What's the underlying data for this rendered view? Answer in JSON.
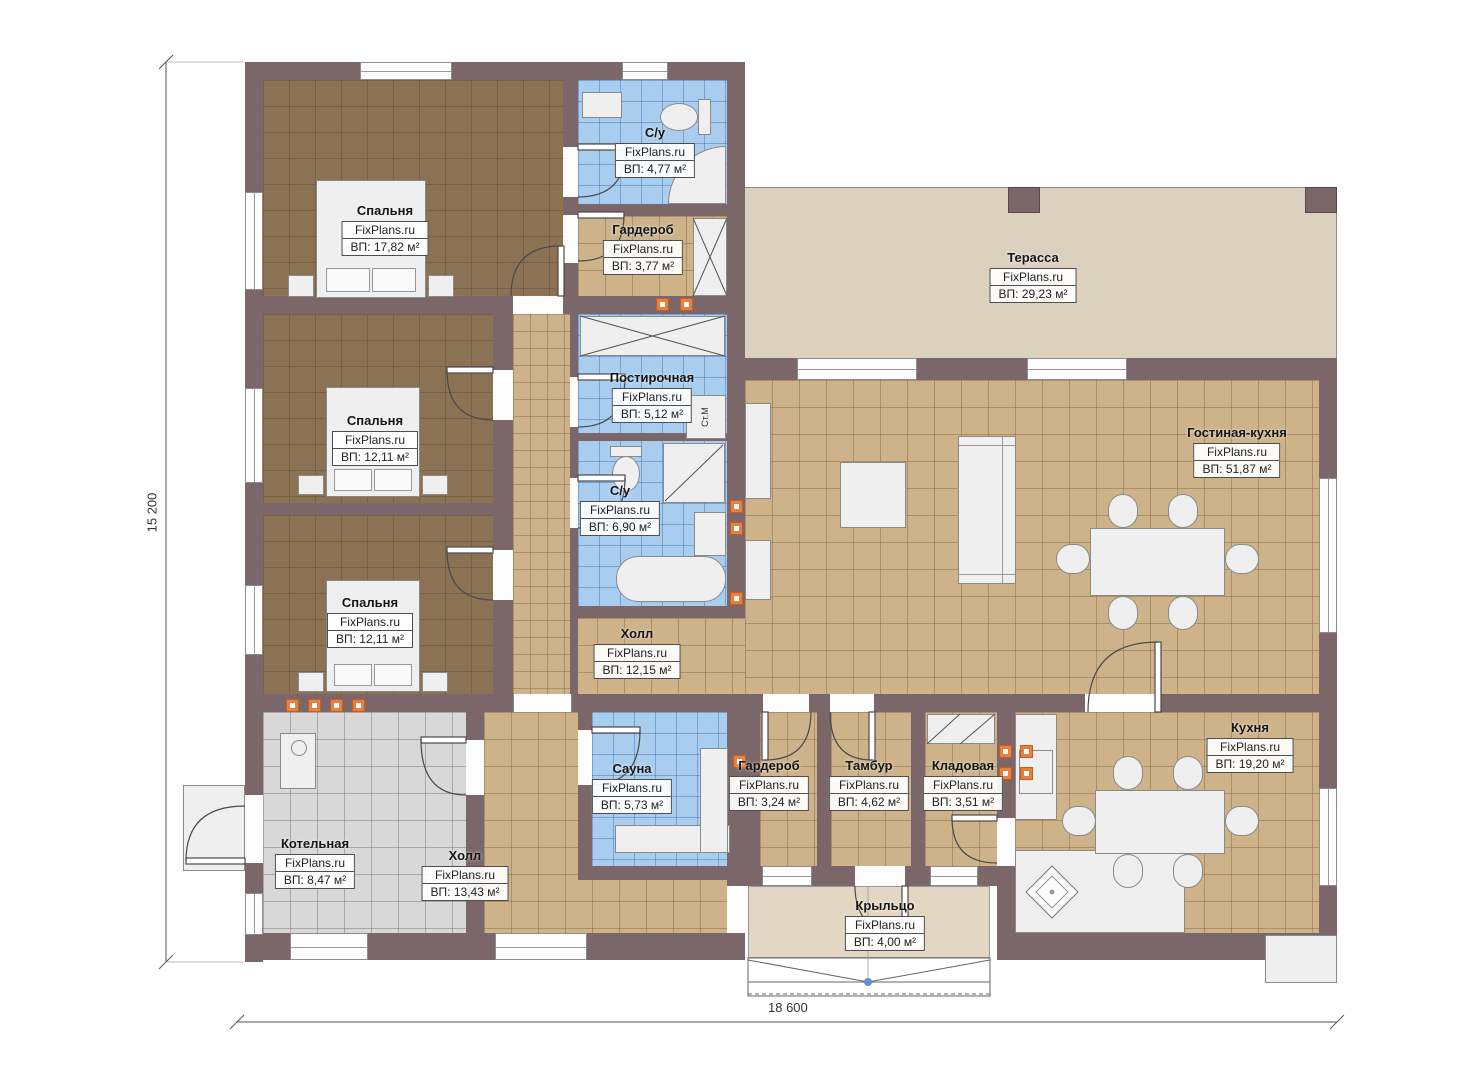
{
  "plan": {
    "watermark": "FixPlans.ru",
    "dim_width": "18 600",
    "dim_height": "15 200",
    "washer_label": "Ст.М",
    "rooms": [
      {
        "name": "Спальня",
        "area": "ВП: 17,82 м²"
      },
      {
        "name": "С/у",
        "area": "ВП: 4,77 м²"
      },
      {
        "name": "Гардероб",
        "area": "ВП: 3,77 м²"
      },
      {
        "name": "Терасса",
        "area": "ВП: 29,23 м²"
      },
      {
        "name": "Спальня",
        "area": "ВП: 12,11 м²"
      },
      {
        "name": "Постирочная",
        "area": "ВП: 5,12 м²"
      },
      {
        "name": "С/у",
        "area": "ВП: 6,90 м²"
      },
      {
        "name": "Гостиная-кухня",
        "area": "ВП: 51,87 м²"
      },
      {
        "name": "Спальня",
        "area": "ВП: 12,11 м²"
      },
      {
        "name": "Холл",
        "area": "ВП: 12,15 м²"
      },
      {
        "name": "Котельная",
        "area": "ВП: 8,47 м²"
      },
      {
        "name": "Холл",
        "area": "ВП: 13,43 м²"
      },
      {
        "name": "Сауна",
        "area": "ВП: 5,73 м²"
      },
      {
        "name": "Гардероб",
        "area": "ВП: 3,24 м²"
      },
      {
        "name": "Тамбур",
        "area": "ВП: 4,62 м²"
      },
      {
        "name": "Кладовая",
        "area": "ВП: 3,51 м²"
      },
      {
        "name": "Кухня",
        "area": "ВП: 19,20 м²"
      },
      {
        "name": "Крыльцо",
        "area": "ВП: 4,00 м²"
      }
    ]
  }
}
